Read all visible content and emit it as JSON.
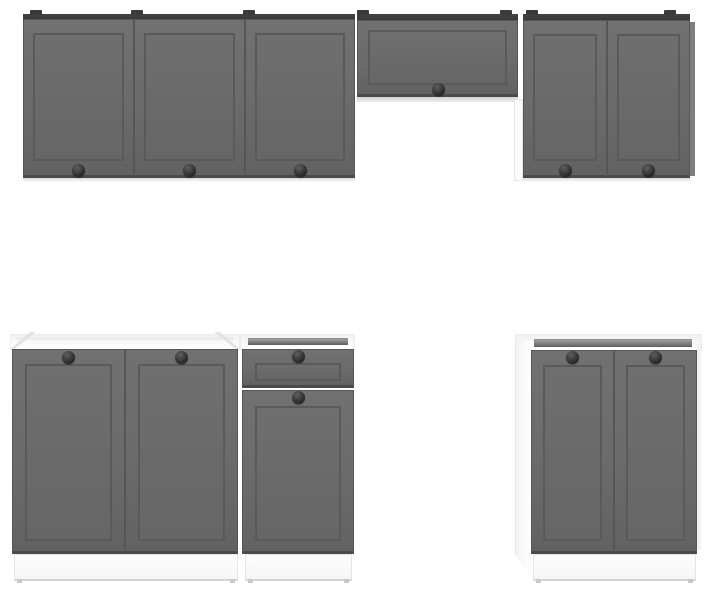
{
  "image": {
    "type": "product-photo",
    "subject": "Modular kitchen cabinet set with graphite gray shaker-style fronts, white carcasses and round black knobs",
    "background": "#ffffff"
  },
  "palette": {
    "background": "#ffffff",
    "door_face": "#6b6b6b",
    "door_face_deep": "#626262",
    "door_groove": "#5a5a5a",
    "door_border": "#565656",
    "door_bottom_edge": "#4a4a4a",
    "cabinet_top": "#424242",
    "mount_tab": "#3a3a3a",
    "knob_dark": "#262626",
    "knob_light": "#5e5e5e",
    "carcass": "#fbfbfb",
    "carcass_edge": "#e6e6e6",
    "underside": "#d2d2d2",
    "recess_dark": "#5f5f5f",
    "recess_light": "#a0a0a0",
    "plinth": "#f6f6f6",
    "plinth_edge": "#d4d4d4",
    "shadow": "#d8d8d8",
    "corner": "#e3e3e3",
    "side_gray": "#7e7e7e"
  },
  "parts": {
    "top_strips": [
      {
        "name": "wall-cabinet-top-left",
        "x": 23,
        "y": 14,
        "w": 332,
        "h": 6
      },
      {
        "name": "hood-cabinet-top",
        "x": 357,
        "y": 14,
        "w": 161,
        "h": 7
      },
      {
        "name": "wall-cabinet-top-right",
        "x": 523,
        "y": 14,
        "w": 167,
        "h": 7
      }
    ],
    "mount_tabs": [
      30,
      131,
      243,
      357,
      500,
      526,
      664
    ],
    "doors": [
      {
        "name": "wall-door-1",
        "x": 23,
        "y": 19,
        "w": 111,
        "h": 159,
        "frame": {
          "t": 13,
          "r": 9,
          "b": 14,
          "l": 9
        },
        "knob": {
          "cx": 78,
          "cy": 170
        }
      },
      {
        "name": "wall-door-2",
        "x": 134,
        "y": 19,
        "w": 111,
        "h": 159,
        "frame": {
          "t": 13,
          "r": 9,
          "b": 14,
          "l": 9
        },
        "knob": {
          "cx": 189,
          "cy": 170
        }
      },
      {
        "name": "wall-door-3",
        "x": 245,
        "y": 19,
        "w": 110,
        "h": 159,
        "frame": {
          "t": 13,
          "r": 9,
          "b": 14,
          "l": 9
        },
        "knob": {
          "cx": 300,
          "cy": 170
        }
      },
      {
        "name": "hood-flip-door",
        "x": 357,
        "y": 20,
        "w": 161,
        "h": 77,
        "frame": {
          "t": 9,
          "r": 10,
          "b": 9,
          "l": 10
        },
        "knob": {
          "cx": 438,
          "cy": 89
        }
      },
      {
        "name": "wall-door-4",
        "x": 523,
        "y": 20,
        "w": 84,
        "h": 158,
        "frame": {
          "t": 13,
          "r": 9,
          "b": 14,
          "l": 9
        },
        "knob": {
          "cx": 565,
          "cy": 170
        }
      },
      {
        "name": "wall-door-5",
        "x": 607,
        "y": 20,
        "w": 83,
        "h": 158,
        "frame": {
          "t": 13,
          "r": 9,
          "b": 14,
          "l": 9
        },
        "knob": {
          "cx": 648,
          "cy": 170
        }
      },
      {
        "name": "sink-base-door-left",
        "x": 12,
        "y": 349,
        "w": 113,
        "h": 205,
        "frame": {
          "t": 14,
          "r": 12,
          "b": 10,
          "l": 12
        },
        "knob": {
          "cx": 68,
          "cy": 357
        }
      },
      {
        "name": "sink-base-door-right",
        "x": 125,
        "y": 349,
        "w": 113,
        "h": 205,
        "frame": {
          "t": 14,
          "r": 12,
          "b": 10,
          "l": 12
        },
        "knob": {
          "cx": 181,
          "cy": 357
        }
      },
      {
        "name": "drawer-front",
        "x": 242,
        "y": 349,
        "w": 112,
        "h": 39,
        "frame": {
          "t": 13,
          "r": 12,
          "b": 4,
          "l": 12
        },
        "knob": {
          "cx": 298,
          "cy": 356
        }
      },
      {
        "name": "base-door-mid",
        "x": 242,
        "y": 390,
        "w": 112,
        "h": 164,
        "frame": {
          "t": 15,
          "r": 12,
          "b": 10,
          "l": 12
        },
        "knob": {
          "cx": 298,
          "cy": 397
        }
      },
      {
        "name": "base-door-right-1",
        "x": 531,
        "y": 350,
        "w": 83,
        "h": 204,
        "frame": {
          "t": 14,
          "r": 11,
          "b": 10,
          "l": 11
        },
        "knob": {
          "cx": 572,
          "cy": 357
        }
      },
      {
        "name": "base-door-right-2",
        "x": 614,
        "y": 350,
        "w": 83,
        "h": 204,
        "frame": {
          "t": 14,
          "r": 11,
          "b": 10,
          "l": 11
        },
        "knob": {
          "cx": 655,
          "cy": 357
        }
      }
    ],
    "white_parts": [
      {
        "name": "hood-underside",
        "x": 357,
        "y": 97,
        "w": 161,
        "h": 5,
        "cls": "underside"
      },
      {
        "name": "wall-right-side-panel-white",
        "x": 514,
        "y": 99,
        "w": 9,
        "h": 82,
        "cls": "carcass-bordered"
      },
      {
        "name": "sink-base-top",
        "x": 10,
        "y": 334,
        "w": 230,
        "h": 16,
        "cls": "topband"
      },
      {
        "name": "drawer-unit-top",
        "x": 240,
        "y": 334,
        "w": 115,
        "h": 16,
        "cls": "topband"
      },
      {
        "name": "base-right-top",
        "x": 515,
        "y": 334,
        "w": 187,
        "h": 17,
        "cls": "topband"
      },
      {
        "name": "base-right-side-panel",
        "x": 515,
        "y": 341,
        "w": 17,
        "h": 237,
        "cls": "side-sloped"
      },
      {
        "name": "base-right-edge",
        "x": 697,
        "y": 344,
        "w": 4,
        "h": 206,
        "cls": "faint"
      },
      {
        "name": "wall-right-side-gray",
        "x": 690,
        "y": 22,
        "w": 5,
        "h": 154,
        "cls": "gray-side"
      }
    ],
    "recesses": [
      {
        "name": "sink-top-recess",
        "x": 16,
        "y": 337,
        "w": 218,
        "h": 3,
        "cls": "light-recess"
      },
      {
        "name": "drawer-top-recess",
        "x": 248,
        "y": 338,
        "w": 100,
        "h": 7,
        "cls": "recess"
      },
      {
        "name": "base-right-top-recess",
        "x": 534,
        "y": 339,
        "w": 158,
        "h": 8,
        "cls": "recess"
      }
    ],
    "shadows": [
      {
        "x": 23,
        "y": 178,
        "w": 332,
        "h": 4
      },
      {
        "x": 523,
        "y": 178,
        "w": 167,
        "h": 4
      }
    ],
    "corners": [
      {
        "name": "sink-top-corner-left",
        "x": 10,
        "y": 332,
        "w": 26,
        "h": 17,
        "cls": "corner-left"
      },
      {
        "name": "sink-top-corner-right",
        "x": 214,
        "y": 332,
        "w": 26,
        "h": 17,
        "cls": "corner-right"
      }
    ],
    "plinths": [
      {
        "name": "plinth-sink-base",
        "x": 14,
        "y": 554,
        "w": 224,
        "h": 27
      },
      {
        "name": "plinth-mid-base",
        "x": 245,
        "y": 554,
        "w": 107,
        "h": 27
      },
      {
        "name": "plinth-right-base",
        "x": 533,
        "y": 554,
        "w": 163,
        "h": 27
      }
    ]
  }
}
